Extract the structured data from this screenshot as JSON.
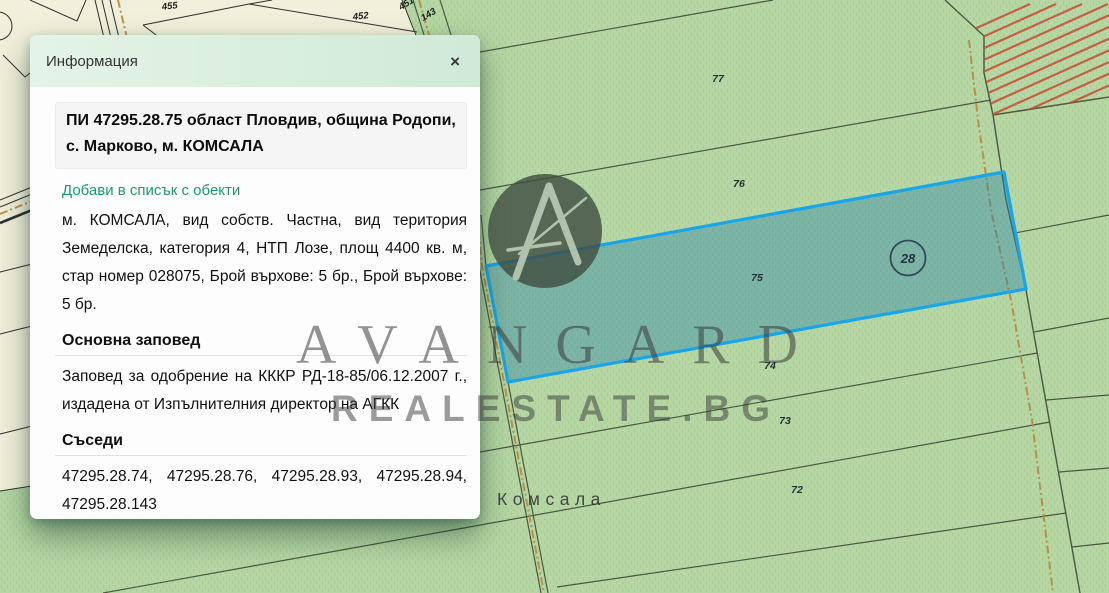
{
  "popup": {
    "header": "Информация",
    "close_glyph": "×",
    "property_title": "ПИ 47295.28.75 област Пловдив, община Родопи, с. Марково, м. КОМСАЛА",
    "add_link": "Добави в списък с обекти",
    "description": "м. КОМСАЛА, вид собств. Частна, вид територия Земеделска, категория 4, НТП Лозе, площ 4400 кв. м, стар номер 028075, Брой върхове: 5 бр., Брой върхове: 5 бр.",
    "sections": [
      {
        "heading": "Основна заповед",
        "text": "Заповед за одобрение на КККР РД-18-85/06.12.2007 г., издадена от Изпълнителния директор на АГКК"
      },
      {
        "heading": "Съседи",
        "text": "47295.28.74, 47295.28.76, 47295.28.93, 47295.28.94, 47295.28.143"
      }
    ]
  },
  "map": {
    "locality": "Комсала",
    "region_circle": "28",
    "parcel_labels": {
      "p77": "77",
      "p76": "76",
      "p75": "75",
      "p74": "74",
      "p73": "73",
      "p72": "72"
    },
    "edge_labels": {
      "n455": "455",
      "n452": "452",
      "n451": "451",
      "n143": "143"
    },
    "colors": {
      "parcel_green": "#b6d7a4",
      "urban_cream": "#f1f0da",
      "selection_fill": "rgba(38,128,168,0.40)",
      "selection_stroke": "#1aa5e9",
      "hatch_red": "#c84a30",
      "easement_orange": "#b98a3c",
      "boundary_dark": "#3f4a3a"
    }
  },
  "watermark": {
    "line1": "AVANGARD",
    "line2": "REALESTATE.BG"
  }
}
